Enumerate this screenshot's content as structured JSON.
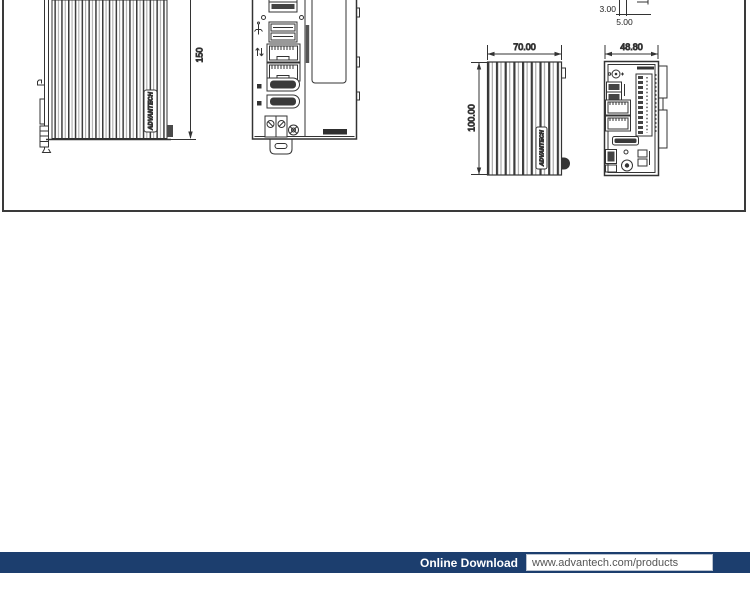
{
  "drawing": {
    "side_view_large": {
      "height_dim": "150",
      "logo": "ADVANTECH"
    },
    "clip_detail": {
      "dim_small": "3.00",
      "dim_large": "5.00"
    },
    "side_view_small": {
      "width_dim": "70.00",
      "height_dim": "100.00",
      "logo": "ADVANTECH"
    },
    "front_view_small": {
      "width_dim": "48.80"
    }
  },
  "footer": {
    "label": "Online Download",
    "url": "www.advantech.com/products",
    "bar_color": "#1c3e6e"
  },
  "colors": {
    "line": "#333333",
    "navy": "#1c3e6e"
  }
}
